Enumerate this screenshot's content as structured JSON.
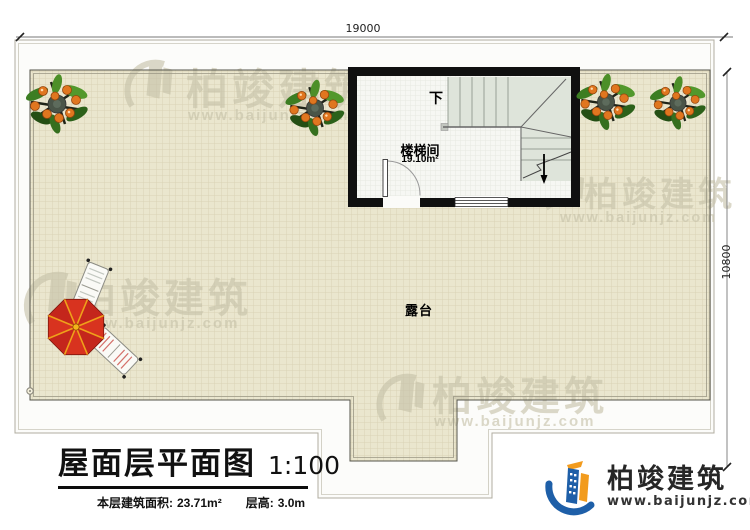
{
  "dimensions": {
    "top": "19000",
    "right": "10800"
  },
  "labels": {
    "terrace": "露台",
    "down": "下"
  },
  "stair_room": {
    "name": "楼梯间",
    "area": "19.10m²"
  },
  "title_block": {
    "title": "屋面层平面图",
    "scale": "1:100",
    "area_label": "本层建筑面积:",
    "area_value": "23.71m²",
    "floor_height_label": "层高:",
    "floor_height_value": "3.0m"
  },
  "branding": {
    "company": "柏竣建筑",
    "website": "www.baijunjz.com"
  },
  "watermark": {
    "text": "柏竣建筑",
    "url": "www.baijunjz.com"
  },
  "colors": {
    "terrace_fill": "#eae6ce",
    "terrace_grid": "#d9d3b5",
    "stair_fill": "#dee4da",
    "wall": "#111111",
    "logo_blue": "#1e5fa8",
    "logo_orange": "#f29b1d",
    "umbrella_red": "#d8331f",
    "watermark": "#c6c1a8"
  }
}
